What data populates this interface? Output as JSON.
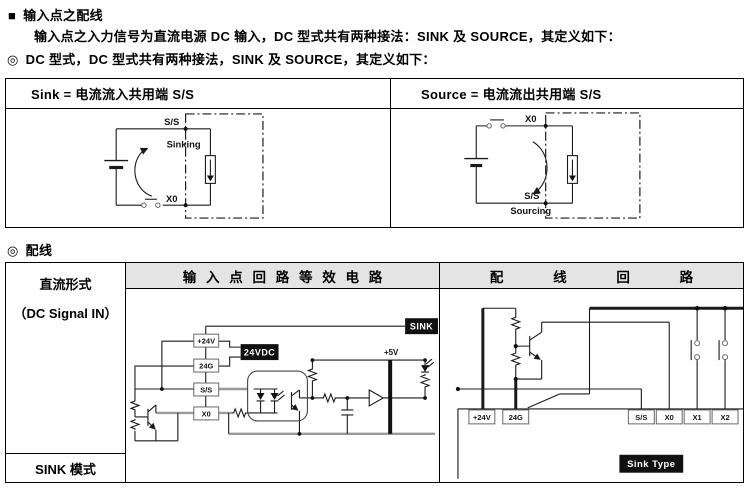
{
  "page": {
    "bullet_square": "■",
    "title": "输入点之配线",
    "intro": "输入点之入力信号为直流电源 DC 输入，DC 型式共有两种接法：SINK 及 SOURCE，其定义如下：",
    "circle_marker": "◎",
    "dc_type_line": "DC 型式，DC 型式共有两种接法，SINK 及 SOURCE，其定义如下：",
    "wiring_heading": "配线"
  },
  "colors": {
    "header_bg": "#e4e4e4",
    "badge_bg": "#111111",
    "wire_gray": "#9a9a9a",
    "line": "#1a1a1a"
  },
  "definition_table": {
    "sink_header": "Sink = 电流流入共用端 S/S",
    "source_header": "Source = 电流流出共用端 S/S",
    "sink_diagram": {
      "top_terminal": "S/S",
      "mode": "Sinking",
      "bottom_terminal": "X0"
    },
    "source_diagram": {
      "top_terminal": "X0",
      "mode": "Sourcing",
      "bottom_terminal": "S/S"
    }
  },
  "wiring_table": {
    "row_label_line1": "直流形式",
    "row_label_line2": "（DC Signal IN）",
    "equiv_header": "输 入 点 回 路 等 效 电 路",
    "wiring_header": "配 线 回 路",
    "mode_label": "SINK 模式",
    "equiv_circuit": {
      "badge": "SINK",
      "supply_label": "24VDC",
      "rail_label": "+5V",
      "terminals": [
        "+24V",
        "24G",
        "S/S",
        "X0"
      ]
    },
    "wiring_circuit": {
      "badge": "Sink Type",
      "terminals": [
        "+24V",
        "24G",
        "S/S",
        "X0",
        "X1",
        "X2"
      ]
    }
  }
}
